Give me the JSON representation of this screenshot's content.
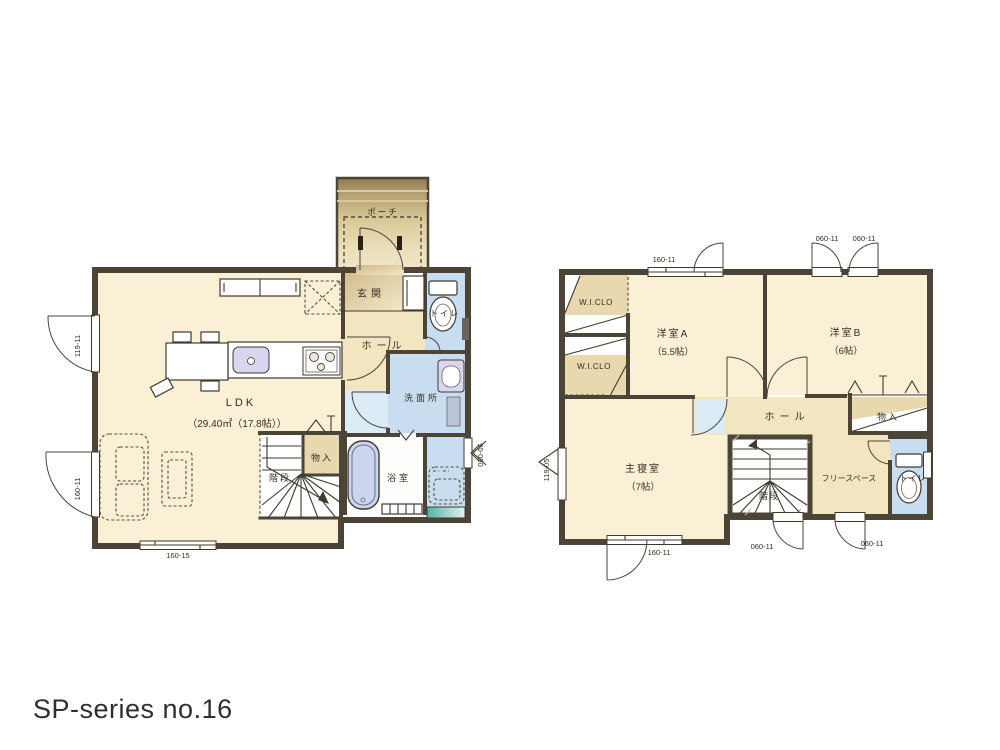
{
  "title": "SP-series no.16",
  "colors": {
    "wall": "#4b4437",
    "floor_cream": "#f9f0d5",
    "floor_beige": "#f2e5bf",
    "closet_tan": "#e8d8ae",
    "wet_area_blue": "#c8def0",
    "pale_blue": "#dcecf6",
    "bathtub_purple": "#cbd5ee",
    "sink_purple": "#d9d6f2",
    "teal_window": "#55b0a8",
    "porch_brown": "#8e7a4e"
  },
  "floor1": {
    "porch": "ポーチ",
    "entrance": "玄関",
    "toilet": "トイレ",
    "hall": "ホール",
    "washroom": "洗面所",
    "ldk": "LDK",
    "ldk_size": "（29.40㎡（17.8帖））",
    "storage": "物入",
    "stairs": "階段",
    "bath": "浴室",
    "win_left_top": "119-11",
    "win_left_bottom": "160-11",
    "win_bottom": "160-15",
    "win_right": "060-06"
  },
  "floor2": {
    "wic_top": "W.I.CLO",
    "wic_bottom": "W.I.CLO",
    "room_a": "洋室A",
    "room_a_size": "（5.5帖）",
    "room_b": "洋室B",
    "room_b_size": "（6帖）",
    "master": "主寝室",
    "master_size": "（7帖）",
    "hall": "ホール",
    "storage": "物入",
    "stairs": "階段",
    "free_space": "フリースペース",
    "toilet": "トイレ",
    "win_top_left": "160-11",
    "win_top_right1": "060-11",
    "win_top_right2": "060-11",
    "win_left": "119-05",
    "win_bottom_left": "160-11",
    "win_bottom_center": "060-11",
    "win_bottom_right": "060-11"
  }
}
